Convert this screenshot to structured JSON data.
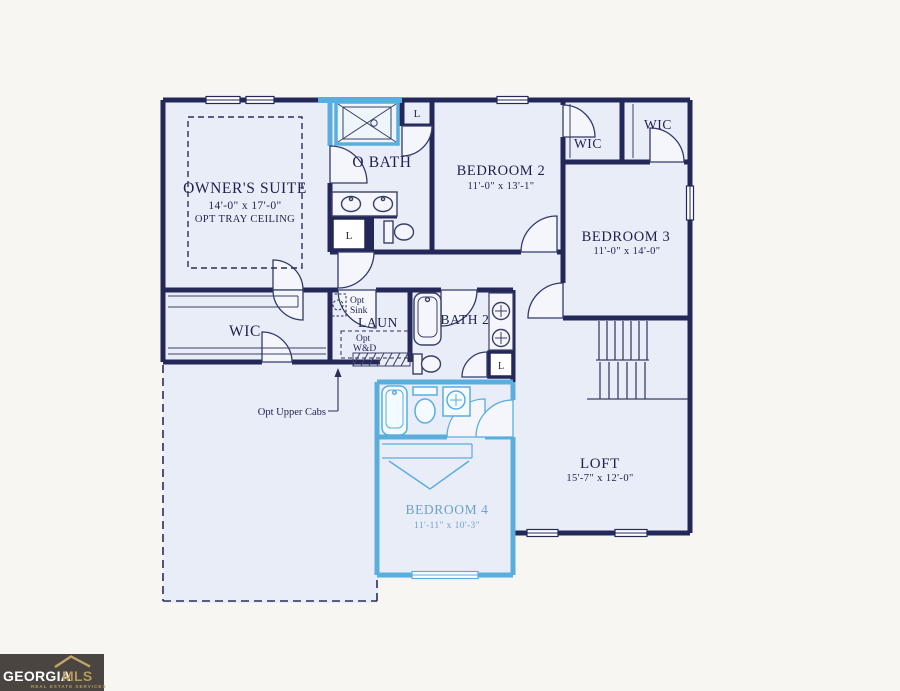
{
  "rooms": {
    "owners_suite": {
      "name": "OWNER'S SUITE",
      "dims": "14'-0\" x 17'-0\"",
      "note": "OPT TRAY CEILING"
    },
    "o_bath": {
      "name": "O BATH"
    },
    "bedroom2": {
      "name": "BEDROOM 2",
      "dims": "11'-0\" x 13'-1\""
    },
    "wic_small": {
      "name": "WIC"
    },
    "wic_right": {
      "name": "WIC"
    },
    "bedroom3": {
      "name": "BEDROOM 3",
      "dims": "11'-0\" x 14'-0\""
    },
    "wic_left": {
      "name": "WIC"
    },
    "laun": {
      "name": "LAUN"
    },
    "bath2": {
      "name": "BATH 2"
    },
    "loft": {
      "name": "LOFT",
      "dims": "15'-7\" x 12'-0\""
    },
    "bedroom4": {
      "name": "BEDROOM 4",
      "dims": "11'-11\" x 10'-3\""
    }
  },
  "annotations": {
    "opt": "Opt",
    "sink": "Sink",
    "wd": "W&D",
    "upper_cabs": "Opt Upper Cabs",
    "linen": "L"
  },
  "logo": {
    "georgia": "GEORGIA",
    "mls": "MLS",
    "tagline": "REAL ESTATE SERVICES"
  },
  "colors": {
    "wall": "#232859",
    "optional_highlight": "#5aaede",
    "room_fill": "#e9edf8",
    "background": "#f7f6f3",
    "bedroom4_text": "#6fa3c6",
    "logo_background": "#4a4540",
    "logo_gold": "#b59a5e",
    "logo_white": "#ffffff"
  }
}
